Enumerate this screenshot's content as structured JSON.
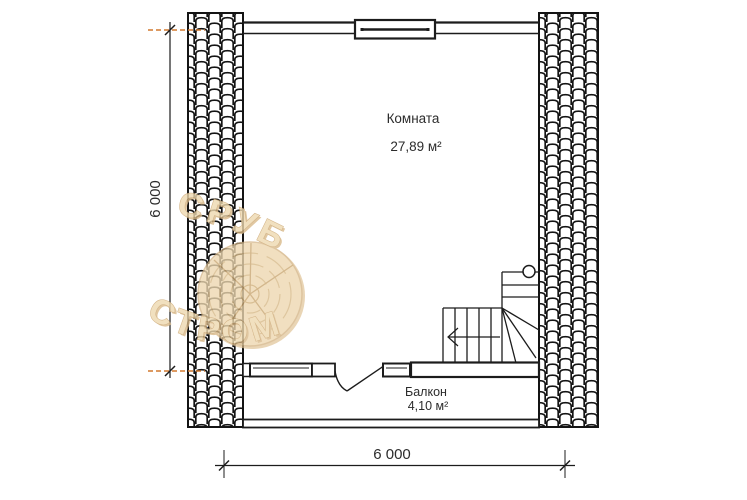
{
  "room": {
    "label": "Комната",
    "area": "27,89 м²"
  },
  "balcony": {
    "label": "Балкон",
    "area": "4,10 м²"
  },
  "dimensions": {
    "left": "6 000",
    "bottom": "6 000"
  },
  "watermark": {
    "top": "СРУБ",
    "bottom": "СТРОМ"
  },
  "colors": {
    "line": "#1c1c1c",
    "extension_line": "#d2792f",
    "watermark_fill": "#eed9b0",
    "watermark_edge": "#c9a26b",
    "text": "#2e2e2e",
    "background": "#ffffff"
  }
}
